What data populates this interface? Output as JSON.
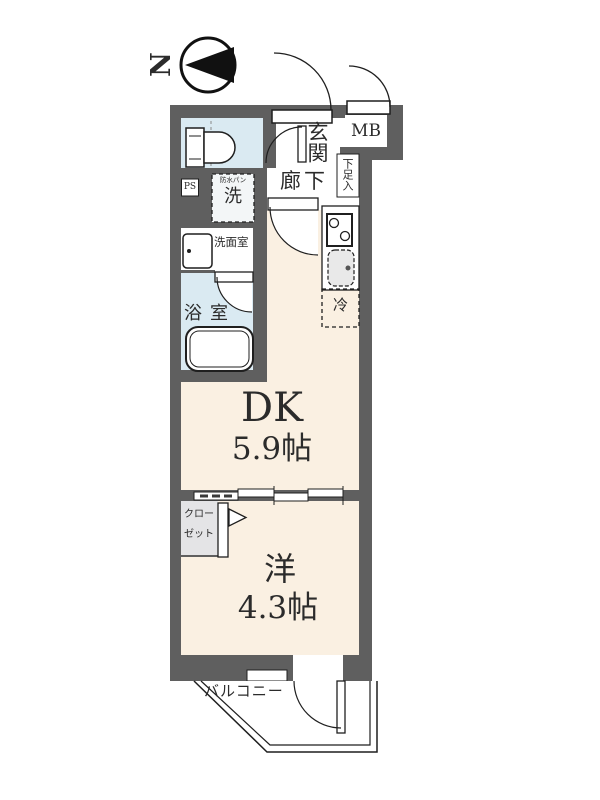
{
  "compass": {
    "north": "N"
  },
  "plan": {
    "entrance": {
      "label": "玄関"
    },
    "meter_box": {
      "label": "MB"
    },
    "hallway": {
      "label": "廊下"
    },
    "shoe_cabinet": {
      "label": "下足入"
    },
    "pipe_shaft": {
      "label": "PS"
    },
    "laundry": {
      "label": "洗",
      "note": "防水パン"
    },
    "washroom": {
      "label": "洗面室"
    },
    "bathroom": {
      "label": "浴室"
    },
    "dining_kitchen": {
      "label": "DK",
      "size": "5.9帖"
    },
    "western_room": {
      "label": "洋",
      "size": "4.3帖"
    },
    "closet": {
      "line1": "クロー",
      "line2": "ゼット"
    },
    "refrigerator": {
      "label": "冷"
    },
    "balcony": {
      "label": "バルコニー"
    }
  },
  "colors": {
    "wall": "#5f5f5f",
    "floor": "#faf0e2",
    "wet_area": "#daeaf2",
    "closet": "#e4e4e6",
    "line": "#1f1f1f"
  }
}
